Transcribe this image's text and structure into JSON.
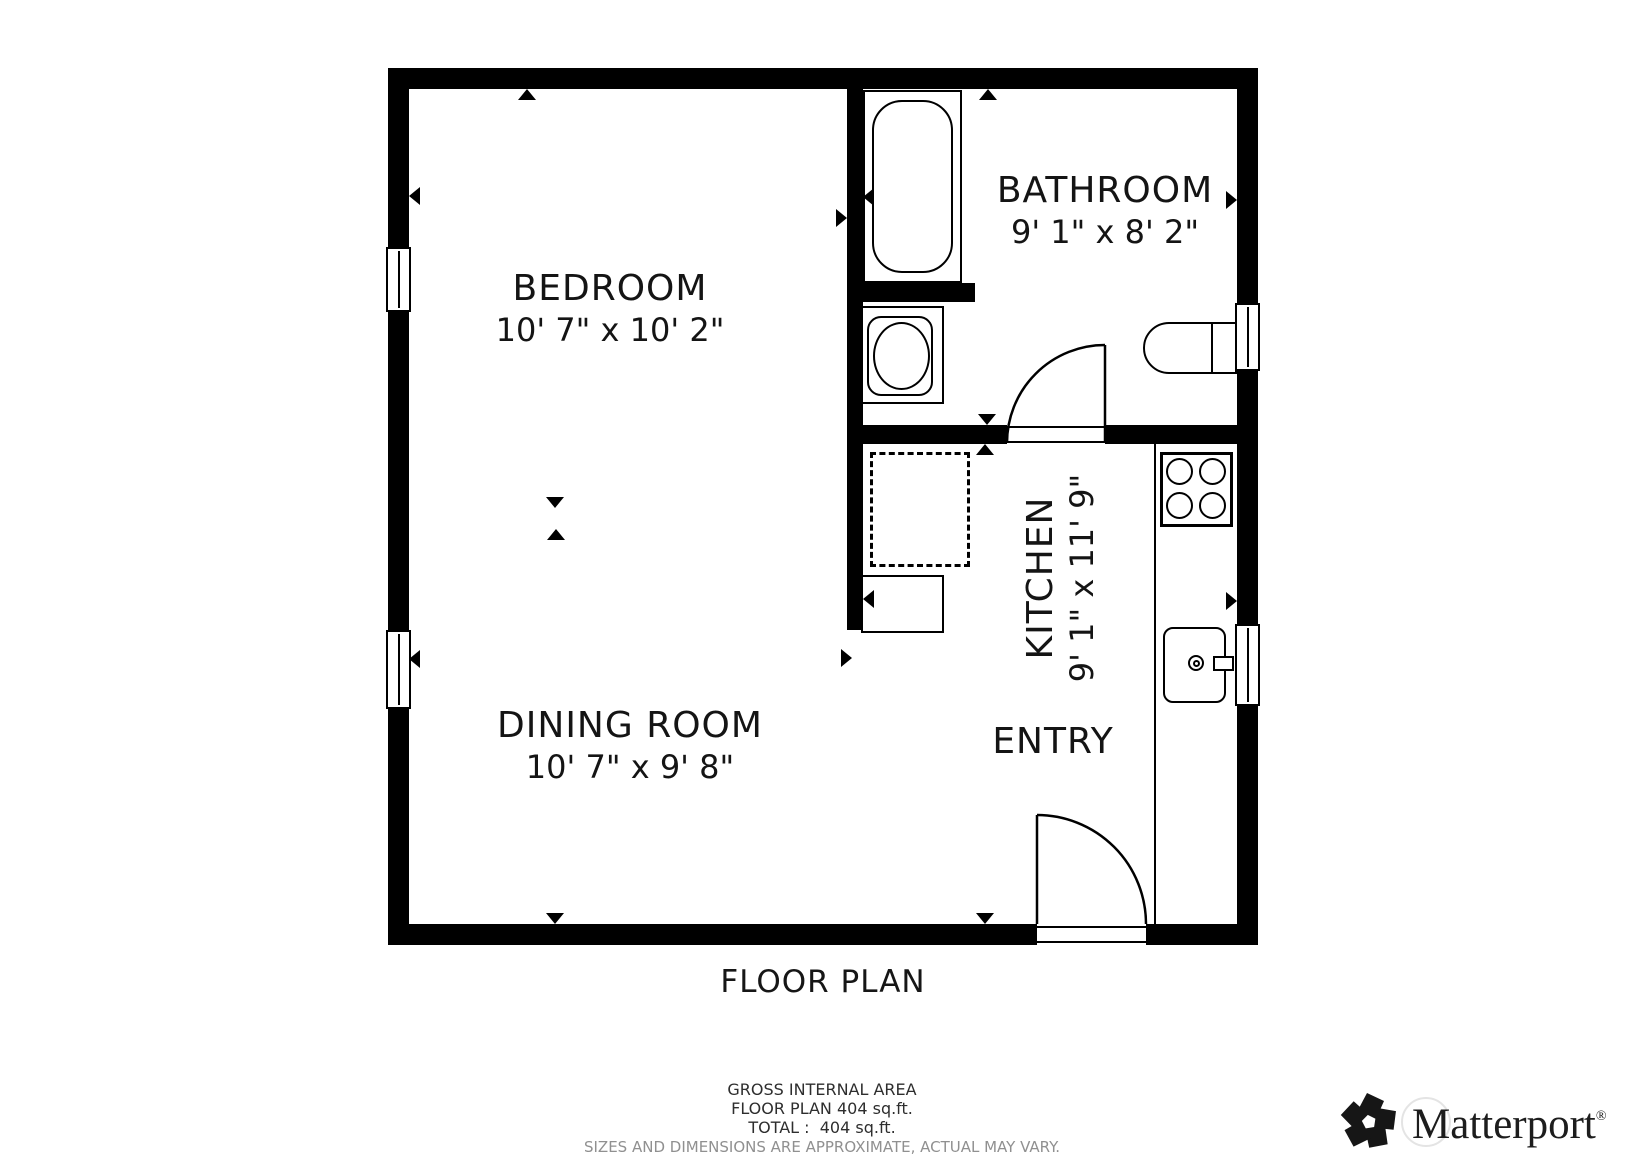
{
  "plan": {
    "caption": "FLOOR PLAN",
    "rooms": {
      "bedroom": {
        "name": "BEDROOM",
        "dims": "10' 7\" x 10' 2\""
      },
      "bathroom": {
        "name": "BATHROOM",
        "dims": "9' 1\" x 8' 2\""
      },
      "kitchen": {
        "name": "KITCHEN",
        "dims": "9' 1\" x 11' 9\""
      },
      "dining_room": {
        "name": "DINING ROOM",
        "dims": "10' 7\" x 9' 8\""
      },
      "entry": {
        "name": "ENTRY"
      }
    },
    "fixtures": [
      "bathtub",
      "toilet",
      "bathroom-sink",
      "stove",
      "kitchen-sink",
      "washer-dashed-outline",
      "entry-cabinet"
    ],
    "windows": 4,
    "doors": 2
  },
  "footer": {
    "line1": "GROSS INTERNAL AREA",
    "line2": "FLOOR PLAN 404 sq.ft.",
    "line3": "TOTAL :  404 sq.ft.",
    "line4": "SIZES AND DIMENSIONS ARE APPROXIMATE, ACTUAL MAY VARY."
  },
  "brand": {
    "name": "Matterport",
    "registered": "®"
  },
  "colors": {
    "wall": "#000000",
    "line": "#111111",
    "muted": "#909090"
  }
}
